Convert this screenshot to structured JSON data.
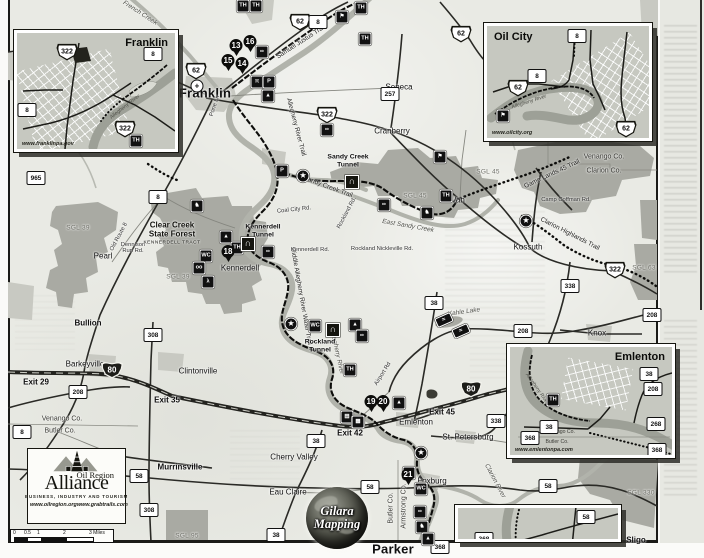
{
  "map": {
    "towns": [
      {
        "name": "Franklin",
        "x": 205,
        "y": 93,
        "big": true
      },
      {
        "name": "Seneca",
        "x": 399,
        "y": 87
      },
      {
        "name": "Cranberry",
        "x": 392,
        "y": 131
      },
      {
        "name": "Van",
        "x": 458,
        "y": 200
      },
      {
        "name": "Kossuth",
        "x": 528,
        "y": 247
      },
      {
        "name": "Pearl",
        "x": 103,
        "y": 256
      },
      {
        "name": "Bullion",
        "x": 88,
        "y": 323,
        "b": true
      },
      {
        "name": "Kennerdell",
        "x": 240,
        "y": 268
      },
      {
        "name": "Barkeyville",
        "x": 85,
        "y": 364
      },
      {
        "name": "Clintonville",
        "x": 198,
        "y": 371
      },
      {
        "name": "Murrinsville",
        "x": 180,
        "y": 467,
        "b": true
      },
      {
        "name": "Cherry Valley",
        "x": 294,
        "y": 457
      },
      {
        "name": "Eau Claire",
        "x": 288,
        "y": 492
      },
      {
        "name": "Emlenton",
        "x": 416,
        "y": 422
      },
      {
        "name": "St. Petersburg",
        "x": 468,
        "y": 437
      },
      {
        "name": "Foxburg",
        "x": 432,
        "y": 481
      },
      {
        "name": "Parker",
        "x": 393,
        "y": 549,
        "big": true
      },
      {
        "name": "Knox",
        "x": 597,
        "y": 333
      },
      {
        "name": "Sligo",
        "x": 636,
        "y": 540,
        "b": true
      }
    ],
    "exits": [
      {
        "label": "Exit 29",
        "x": 36,
        "y": 382
      },
      {
        "label": "Exit 35",
        "x": 167,
        "y": 400
      },
      {
        "label": "Exit 42",
        "x": 350,
        "y": 433
      },
      {
        "label": "Exit 45",
        "x": 442,
        "y": 412
      }
    ],
    "counties": [
      {
        "t": "Venango Co.",
        "x": 604,
        "y": 157
      },
      {
        "t": "Clarion Co.",
        "x": 604,
        "y": 171
      },
      {
        "t": "Venango Co.",
        "x": 62,
        "y": 419
      },
      {
        "t": "Butler Co.",
        "x": 60,
        "y": 431
      },
      {
        "t": "Butler Co.",
        "x": 391,
        "y": 508,
        "r": -90
      },
      {
        "t": "Armstrong Co.",
        "x": 404,
        "y": 506,
        "r": -90
      }
    ],
    "areas": [
      {
        "t": "SGL 39",
        "x": 78,
        "y": 228
      },
      {
        "t": "SGL 39",
        "x": 178,
        "y": 277
      },
      {
        "t": "SGL 45",
        "x": 415,
        "y": 196
      },
      {
        "t": "SGL 45",
        "x": 488,
        "y": 172
      },
      {
        "t": "SGL 63",
        "x": 644,
        "y": 268
      },
      {
        "t": "SGL 95",
        "x": 187,
        "y": 536
      },
      {
        "t": "SGL 330",
        "x": 641,
        "y": 493
      }
    ],
    "forest": {
      "title": "Clear Creek\nState Forest",
      "sub": "KENNERDELL TRACT",
      "x": 172,
      "y": 234
    },
    "waterways": [
      {
        "t": "French Creek",
        "x": 140,
        "y": 13,
        "r": 33
      },
      {
        "t": "Allegheny River",
        "x": 337,
        "y": 352,
        "r": 78
      },
      {
        "t": "East Sandy Creek",
        "x": 408,
        "y": 226,
        "r": 10
      },
      {
        "t": "Kahle Lake",
        "x": 464,
        "y": 312,
        "r": -8
      },
      {
        "t": "Clarion River",
        "x": 495,
        "y": 481,
        "r": 62
      }
    ],
    "trail_labels": [
      {
        "t": "Samuel Justus Trail",
        "x": 301,
        "y": 42,
        "r": -33
      },
      {
        "t": "Allegheny River Trail",
        "x": 296,
        "y": 127,
        "r": 75
      },
      {
        "t": "Sandy Creek Trail",
        "x": 328,
        "y": 187,
        "r": 20
      },
      {
        "t": "Middle Allegheny River Water Trail",
        "x": 301,
        "y": 296,
        "r": 80
      },
      {
        "t": "Game Lands 45 Trail",
        "x": 552,
        "y": 174,
        "r": -25
      },
      {
        "t": "Clarion Highlands Trail",
        "x": 570,
        "y": 234,
        "r": 27
      }
    ],
    "road_labels": [
      {
        "t": "Coal City Rd.",
        "x": 294,
        "y": 210,
        "r": -6
      },
      {
        "t": "Kennerdell Rd.",
        "x": 310,
        "y": 250
      },
      {
        "t": "Rockland Nickleville Rd.",
        "x": 382,
        "y": 249
      },
      {
        "t": "Dennison\nRun Rd.",
        "x": 133,
        "y": 248
      },
      {
        "t": "Old Route 8",
        "x": 119,
        "y": 237,
        "r": -62
      },
      {
        "t": "Camp Coffman Rd.",
        "x": 566,
        "y": 200
      },
      {
        "t": "Airport Rd",
        "x": 383,
        "y": 374,
        "r": -58
      },
      {
        "t": "Rockland Rd.",
        "x": 347,
        "y": 213,
        "r": -62
      },
      {
        "t": "Pone Ln",
        "x": 215,
        "y": 106,
        "r": -72
      }
    ],
    "tunnels": [
      {
        "label": "Sandy Creek\nTunnel",
        "x": 348,
        "y": 161,
        "ix": 352,
        "iy": 182
      },
      {
        "label": "Kennerdell\nTunnel",
        "x": 263,
        "y": 231,
        "ix": 248,
        "iy": 244
      },
      {
        "label": "Rockland\nTunnel",
        "x": 320,
        "y": 346,
        "ix": 333,
        "iy": 330
      }
    ],
    "shields": [
      {
        "t": "us",
        "n": "62",
        "x": 300,
        "y": 22
      },
      {
        "t": "us",
        "n": "62",
        "x": 196,
        "y": 71
      },
      {
        "t": "us",
        "n": "62",
        "x": 461,
        "y": 34
      },
      {
        "t": "us",
        "n": "322",
        "x": 327,
        "y": 115
      },
      {
        "t": "us",
        "n": "322",
        "x": 615,
        "y": 270
      },
      {
        "t": "i80",
        "n": "80",
        "x": 112,
        "y": 370
      },
      {
        "t": "i80",
        "n": "80",
        "x": 471,
        "y": 389
      },
      {
        "t": "state",
        "n": "8",
        "x": 318,
        "y": 22
      },
      {
        "t": "state",
        "n": "8",
        "x": 158,
        "y": 197
      },
      {
        "t": "state",
        "n": "8",
        "x": 22,
        "y": 432
      },
      {
        "t": "state",
        "n": "257",
        "x": 390,
        "y": 94
      },
      {
        "t": "state",
        "n": "208",
        "x": 78,
        "y": 392
      },
      {
        "t": "state",
        "n": "208",
        "x": 523,
        "y": 331
      },
      {
        "t": "state",
        "n": "208",
        "x": 652,
        "y": 315
      },
      {
        "t": "state",
        "n": "38",
        "x": 434,
        "y": 303
      },
      {
        "t": "state",
        "n": "38",
        "x": 316,
        "y": 441
      },
      {
        "t": "state",
        "n": "38",
        "x": 276,
        "y": 535
      },
      {
        "t": "state",
        "n": "338",
        "x": 570,
        "y": 286
      },
      {
        "t": "state",
        "n": "338",
        "x": 496,
        "y": 421
      },
      {
        "t": "state",
        "n": "58",
        "x": 139,
        "y": 476
      },
      {
        "t": "state",
        "n": "58",
        "x": 370,
        "y": 487
      },
      {
        "t": "state",
        "n": "58",
        "x": 548,
        "y": 486
      },
      {
        "t": "state",
        "n": "308",
        "x": 153,
        "y": 335
      },
      {
        "t": "state",
        "n": "308",
        "x": 149,
        "y": 510
      },
      {
        "t": "state",
        "n": "368",
        "x": 440,
        "y": 547
      },
      {
        "t": "state",
        "n": "965",
        "x": 36,
        "y": 178
      }
    ],
    "markers": [
      {
        "n": "13",
        "x": 236,
        "y": 54
      },
      {
        "n": "16",
        "x": 250,
        "y": 50
      },
      {
        "n": "15",
        "x": 228,
        "y": 69
      },
      {
        "n": "14",
        "x": 242,
        "y": 72
      },
      {
        "n": "18",
        "x": 228,
        "y": 260
      },
      {
        "n": "19",
        "x": 371,
        "y": 410
      },
      {
        "n": "20",
        "x": 383,
        "y": 410
      },
      {
        "n": "21",
        "x": 408,
        "y": 483
      }
    ],
    "icon_glyphs": {
      "th": "TH",
      "parking": "P",
      "picnic": "π",
      "camp": "▲",
      "bike": "∞",
      "horse": "♞",
      "restroom": "WC",
      "flag": "⚑",
      "star": "★",
      "binoc": "oo",
      "hiker": "λ",
      "museum": "▤",
      "factory": "▦",
      "boat": "≈",
      "tunnel": "∩",
      "hospital": "+"
    },
    "icons": [
      {
        "g": "th",
        "x": 243,
        "y": 6
      },
      {
        "g": "th",
        "x": 256,
        "y": 6
      },
      {
        "g": "th",
        "x": 361,
        "y": 8
      },
      {
        "g": "flag",
        "x": 342,
        "y": 17
      },
      {
        "g": "bike",
        "x": 262,
        "y": 52
      },
      {
        "g": "th",
        "x": 365,
        "y": 39
      },
      {
        "g": "picnic",
        "x": 257,
        "y": 82
      },
      {
        "g": "parking",
        "x": 269,
        "y": 82
      },
      {
        "g": "camp",
        "x": 268,
        "y": 96
      },
      {
        "g": "bike",
        "x": 327,
        "y": 130
      },
      {
        "g": "parking",
        "x": 282,
        "y": 171
      },
      {
        "g": "star",
        "x": 303,
        "y": 176
      },
      {
        "g": "flag",
        "x": 440,
        "y": 157
      },
      {
        "g": "bike",
        "x": 384,
        "y": 205
      },
      {
        "g": "horse",
        "x": 427,
        "y": 213
      },
      {
        "g": "th",
        "x": 446,
        "y": 196
      },
      {
        "g": "star",
        "x": 526,
        "y": 221
      },
      {
        "g": "horse",
        "x": 197,
        "y": 206
      },
      {
        "g": "camp",
        "x": 226,
        "y": 237
      },
      {
        "g": "restroom",
        "x": 206,
        "y": 256
      },
      {
        "g": "th",
        "x": 237,
        "y": 248
      },
      {
        "g": "binoc",
        "x": 199,
        "y": 268
      },
      {
        "g": "hiker",
        "x": 208,
        "y": 282
      },
      {
        "g": "bike",
        "x": 268,
        "y": 252
      },
      {
        "g": "star",
        "x": 291,
        "y": 324
      },
      {
        "g": "restroom",
        "x": 315,
        "y": 326
      },
      {
        "g": "camp",
        "x": 355,
        "y": 325
      },
      {
        "g": "bike",
        "x": 362,
        "y": 336
      },
      {
        "g": "th",
        "x": 350,
        "y": 370
      },
      {
        "g": "boat",
        "x": 444,
        "y": 320
      },
      {
        "g": "boat",
        "x": 461,
        "y": 331
      },
      {
        "g": "camp",
        "x": 399,
        "y": 403
      },
      {
        "g": "museum",
        "x": 347,
        "y": 417
      },
      {
        "g": "factory",
        "x": 358,
        "y": 422
      },
      {
        "g": "star",
        "x": 421,
        "y": 453
      },
      {
        "g": "flag",
        "x": 409,
        "y": 473
      },
      {
        "g": "restroom",
        "x": 421,
        "y": 489
      },
      {
        "g": "bike",
        "x": 420,
        "y": 512
      },
      {
        "g": "horse",
        "x": 422,
        "y": 527
      },
      {
        "g": "camp",
        "x": 428,
        "y": 539
      }
    ],
    "hospital": {
      "x": 197,
      "y": 86
    },
    "poi_blob": {
      "x": 432,
      "y": 394
    }
  },
  "insets": [
    {
      "id": "franklin",
      "title": "Franklin",
      "website": "www.franklinpa.gov",
      "x": 14,
      "y": 30,
      "w": 164,
      "h": 122,
      "tc": "tr",
      "shields": [
        {
          "t": "us",
          "n": "322",
          "x": 50,
          "y": 19
        },
        {
          "t": "state",
          "n": "8",
          "x": 136,
          "y": 21
        },
        {
          "t": "state",
          "n": "8",
          "x": 10,
          "y": 77
        },
        {
          "t": "us",
          "n": "322",
          "x": 108,
          "y": 96
        }
      ],
      "icons": [
        {
          "g": "th",
          "x": 119,
          "y": 108
        }
      ],
      "labels": [
        {
          "t": "Allegheny River",
          "x": 108,
          "y": 74,
          "r": -38
        }
      ]
    },
    {
      "id": "oilcity",
      "title": "Oil City",
      "website": "www.oilcity.org",
      "x": 484,
      "y": 23,
      "w": 168,
      "h": 118,
      "tc": "tl",
      "shields": [
        {
          "t": "state",
          "n": "8",
          "x": 90,
          "y": 10
        },
        {
          "t": "state",
          "n": "8",
          "x": 50,
          "y": 50
        },
        {
          "t": "us",
          "n": "62",
          "x": 31,
          "y": 62
        },
        {
          "t": "us",
          "n": "62",
          "x": 139,
          "y": 103
        }
      ],
      "icons": [
        {
          "g": "flag",
          "x": 16,
          "y": 90
        }
      ],
      "labels": [
        {
          "t": "Allegheny River",
          "x": 42,
          "y": 76,
          "r": -18
        }
      ]
    },
    {
      "id": "emlenton",
      "title": "Emlenton",
      "website": "www.emlentonpa.com",
      "x": 507,
      "y": 344,
      "w": 168,
      "h": 114,
      "tc": "tr",
      "shields": [
        {
          "t": "state",
          "n": "38",
          "x": 139,
          "y": 27
        },
        {
          "t": "state",
          "n": "208",
          "x": 143,
          "y": 42
        },
        {
          "t": "state",
          "n": "38",
          "x": 39,
          "y": 80
        },
        {
          "t": "state",
          "n": "368",
          "x": 20,
          "y": 91
        },
        {
          "t": "state",
          "n": "268",
          "x": 146,
          "y": 77
        },
        {
          "t": "state",
          "n": "368",
          "x": 147,
          "y": 103
        }
      ],
      "icons": [
        {
          "g": "th",
          "x": 43,
          "y": 53
        }
      ],
      "labels": [
        {
          "t": "Allegheny River",
          "x": 27,
          "y": 42,
          "r": 55
        }
      ],
      "counties": [
        {
          "t": "Venango Co.",
          "x": 50,
          "y": 85
        },
        {
          "t": "Butler Co.",
          "x": 47,
          "y": 95
        }
      ]
    },
    {
      "id": "parker",
      "title": "",
      "website": "",
      "x": 455,
      "y": 505,
      "w": 166,
      "h": 37,
      "tc": "tl",
      "shields": [
        {
          "t": "state",
          "n": "58",
          "x": 128,
          "y": 9
        },
        {
          "t": "state",
          "n": "368",
          "x": 26,
          "y": 31
        }
      ],
      "icons": [],
      "labels": []
    }
  ],
  "alliance": {
    "line1": "Oil Region",
    "line2": "Alliance",
    "tagline": "BUSINESS, INDUSTRY AND TOURISM",
    "web1": "www.oilregion.org",
    "web2": "www.grabtrails.com"
  },
  "gilara": {
    "line1": "Gilara",
    "line2": "Mapping"
  },
  "scalebar": {
    "ticks": [
      "0",
      "0.5",
      "1",
      "2",
      "3 Miles"
    ]
  },
  "colors": {
    "paper": "#e9eae4",
    "gameland": "#a9aaa3",
    "ink": "#15150f",
    "river": "#b1b3ab"
  }
}
